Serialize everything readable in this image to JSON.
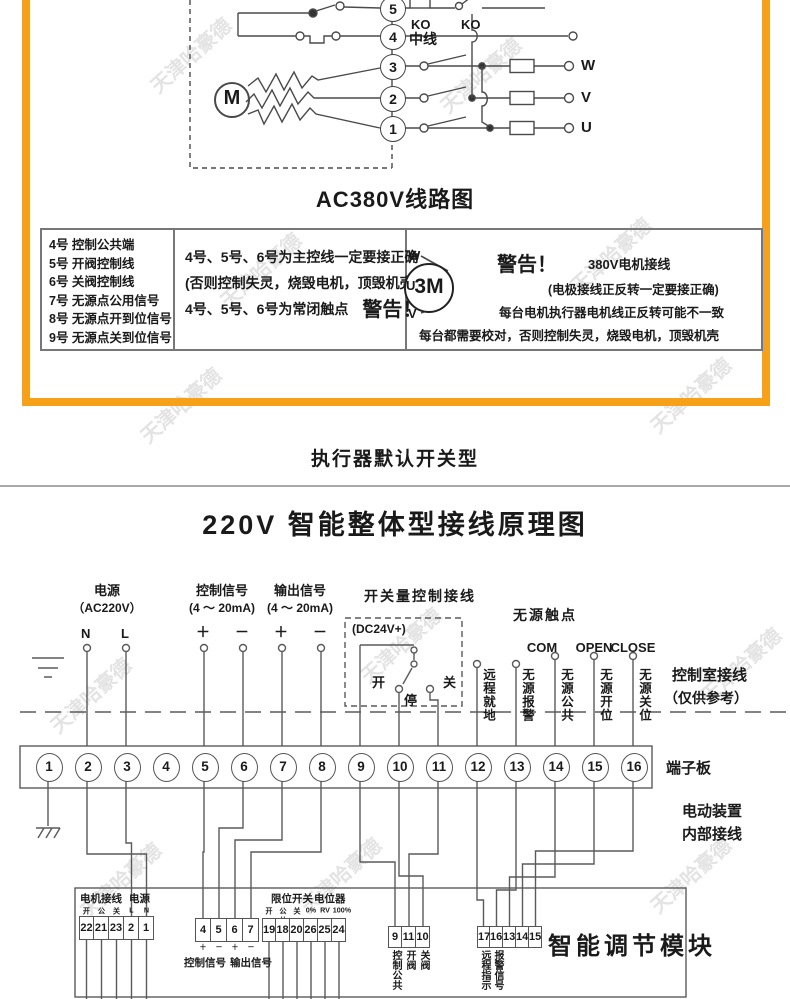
{
  "watermark": "天津哈豪德",
  "ac380": {
    "terminals": [
      "5",
      "4",
      "3",
      "2",
      "1"
    ],
    "ko1": "KO",
    "ko2": "KO",
    "neutral": "中线",
    "motor": "M",
    "phases": [
      "W",
      "V",
      "U"
    ],
    "title": "AC380V线路图",
    "table": {
      "col1": [
        "4号 控制公共端",
        "5号 开阀控制线",
        "6号 关阀控制线",
        "7号 无源点公用信号",
        "8号 无源点开到位信号",
        "9号 无源点关到位信号"
      ],
      "col2_line1": "4号、5号、6号为主控线一定要接正确",
      "col2_line2": "(否则控制失灵，烧毁电机，顶毁机壳)",
      "col2_line3": "4号、5号、6号为常闭触点",
      "col2_warning": "警告！",
      "col3_motor": "3M",
      "col3_phases": [
        "W",
        "U",
        "V"
      ],
      "col3_warning": "警告！",
      "col3_line1": "380V电机接线",
      "col3_line2": "(电极接线正反转一定要接正确)",
      "col3_line3": "每台电机执行器电机线正反转可能不一致",
      "col3_line4": "每台都需要校对，否则控制失灵，烧毁电机，顶毁机壳"
    }
  },
  "section_heading": "执行器默认开关型",
  "diagram220": {
    "title": "220V 智能整体型接线原理图",
    "power_label": "电源",
    "power_sub": "（AC220V）",
    "n": "N",
    "l": "L",
    "control_label": "控制信号",
    "control_sub": "(4 ～ 20mA)",
    "output_label": "输出信号",
    "output_sub": "(4 ～ 20mA)",
    "plus": "＋",
    "minus": "－",
    "switch_label": "开关量控制接线",
    "dc24": "(DC24V+)",
    "sw_open": "开",
    "sw_stop": "停",
    "sw_close": "关",
    "passive_label": "无源触点",
    "com": "COM",
    "open_en": "OPEN",
    "close_en": "CLOSE",
    "vertical_labels": [
      "远程就地",
      "无源报警",
      "无源公共",
      "无源开位",
      "无源关位"
    ],
    "control_room1": "控制室接线",
    "control_room2": "（仅供参考）",
    "board_label": "端子板",
    "terminals": [
      "1",
      "2",
      "3",
      "4",
      "5",
      "6",
      "7",
      "8",
      "9",
      "10",
      "11",
      "12",
      "13",
      "14",
      "15",
      "16"
    ],
    "device_line1": "电动装置",
    "device_line2": "内部接线",
    "module_label": "智能调节模块",
    "strip_motor": {
      "label1": "电机接线",
      "label2": "电源",
      "subs": [
        "开",
        "公共",
        "关",
        "L",
        "N"
      ],
      "cells": [
        "22",
        "21",
        "23",
        "2",
        "1"
      ]
    },
    "strip_signal": {
      "cells": [
        "4",
        "5",
        "6",
        "7"
      ],
      "subs": [
        "＋",
        "－",
        "＋",
        "－"
      ],
      "label1": "控制信号",
      "label2": "输出信号"
    },
    "strip_limit": {
      "label1": "限位开关",
      "label2": "电位器",
      "subs": [
        "开",
        "公共",
        "关",
        "0%",
        "RV",
        "100%"
      ],
      "cells": [
        "19",
        "18",
        "20",
        "26",
        "25",
        "24"
      ]
    },
    "strip_valve": {
      "cells": [
        "9",
        "11",
        "10"
      ],
      "vlabels": [
        "控制公共",
        "开阀",
        "关阀"
      ]
    },
    "strip_remote": {
      "cells": [
        "17",
        "16",
        "13",
        "14",
        "15"
      ],
      "vlabels": [
        "远程指示",
        "报警信号"
      ]
    }
  }
}
